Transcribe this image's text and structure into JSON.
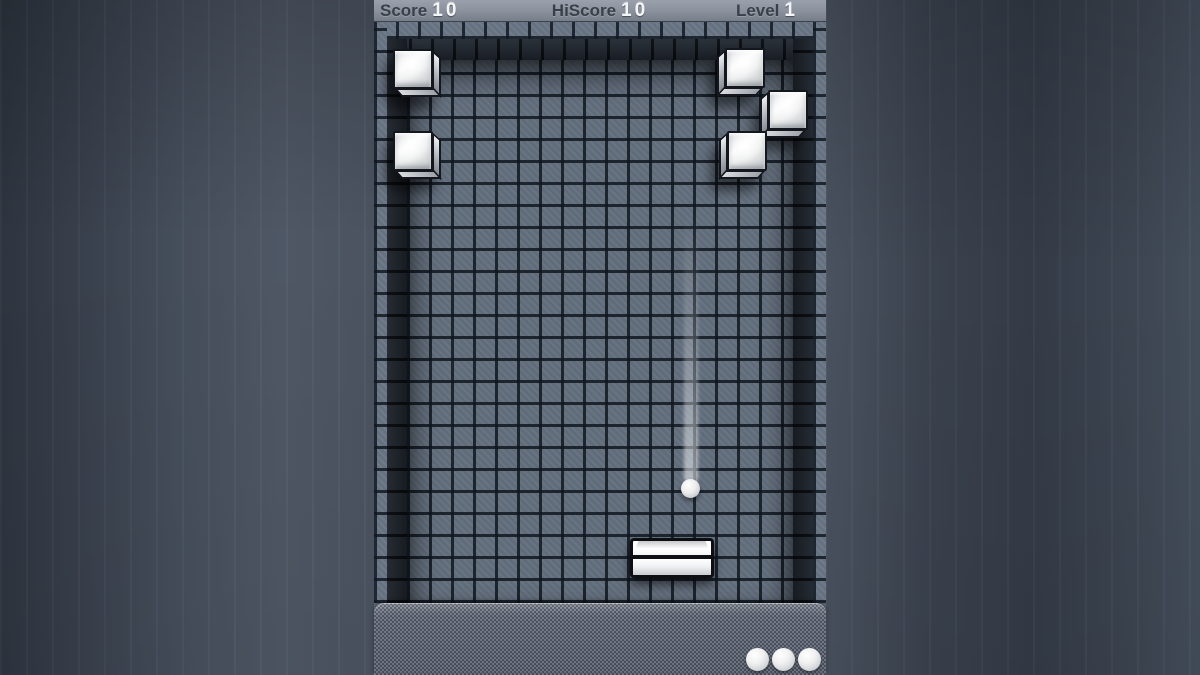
{
  "status_bar": {
    "score_label": "Score",
    "score_value": "10",
    "hiscore_label": "HiScore",
    "hiscore_value": "10",
    "level_label": "Level",
    "level_value": "1"
  },
  "playfield": {
    "bricks": [
      {
        "id": "brick-top-left-1",
        "side": "left",
        "x": 19,
        "y": 49
      },
      {
        "id": "brick-top-left-2",
        "side": "left",
        "x": 19,
        "y": 131
      },
      {
        "id": "brick-top-right-1",
        "side": "right",
        "x": 351,
        "y": 48
      },
      {
        "id": "brick-top-right-2",
        "side": "right",
        "x": 394,
        "y": 90
      },
      {
        "id": "brick-top-right-3",
        "side": "right",
        "x": 353,
        "y": 131
      }
    ],
    "ball": {
      "x": 307,
      "y": 479,
      "size": 19
    },
    "ball_trail": {
      "x": 310,
      "top": 212,
      "height": 272,
      "width": 14
    },
    "paddle": {
      "x": 256,
      "y": 538,
      "width": 84,
      "height": 40
    }
  },
  "lives_panel": {
    "count": 3
  },
  "colors": {
    "backdrop": "#3a424e",
    "status_bar_bg": "#8a919c",
    "label_color": "#3a4049",
    "value_color": "#f4f5f7",
    "field_fill": "#646f7e",
    "grid_line": "#101720",
    "wall": "#10151c",
    "brick_face": "#f2f3f4",
    "panel_bg": "#7b8290",
    "ball_color": "#ffffff"
  }
}
